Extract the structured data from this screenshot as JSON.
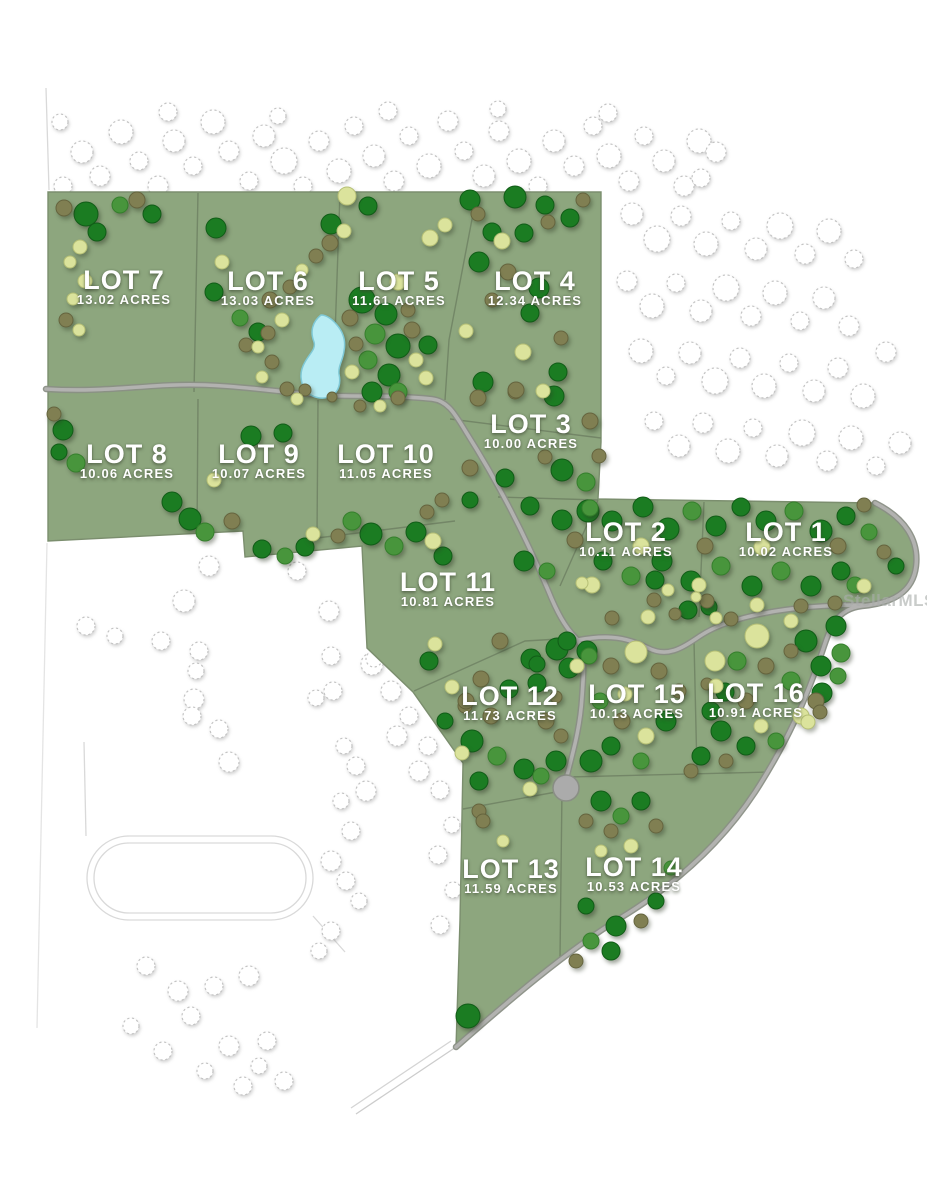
{
  "map": {
    "watermark": "StellarMLS",
    "lots": [
      {
        "name": "LOT 7",
        "acres": "13.02 ACRES"
      },
      {
        "name": "LOT 6",
        "acres": "13.03 ACRES"
      },
      {
        "name": "LOT 5",
        "acres": "11.61 ACRES"
      },
      {
        "name": "LOT 4",
        "acres": "12.34 ACRES"
      },
      {
        "name": "LOT 3",
        "acres": "10.00 ACRES"
      },
      {
        "name": "LOT 8",
        "acres": "10.06 ACRES"
      },
      {
        "name": "LOT 9",
        "acres": "10.07 ACRES"
      },
      {
        "name": "LOT 10",
        "acres": "11.05 ACRES"
      },
      {
        "name": "LOT 2",
        "acres": "10.11 ACRES"
      },
      {
        "name": "LOT 1",
        "acres": "10.02 ACRES"
      },
      {
        "name": "LOT 11",
        "acres": "10.81 ACRES"
      },
      {
        "name": "LOT 12",
        "acres": "11.73 ACRES"
      },
      {
        "name": "LOT 15",
        "acres": "10.13 ACRES"
      },
      {
        "name": "LOT 16",
        "acres": "10.91 ACRES"
      },
      {
        "name": "LOT 13",
        "acres": "11.59 ACRES"
      },
      {
        "name": "LOT 14",
        "acres": "10.53 ACRES"
      }
    ],
    "palette": {
      "parcel_green": "#8da67e",
      "boundary_line": "#748767",
      "road_gray": "#b2b2b0",
      "road_casing": "#8a8f85",
      "pond_blue": "#b9edf4",
      "tree_dark_green": "#1b7c22",
      "tree_mid_green": "#48953c",
      "tree_olive": "#807f52",
      "tree_pale": "#dbe39c",
      "tree_unplatted_outline": "#c3c3c3",
      "label_text": "#ffffff"
    }
  }
}
